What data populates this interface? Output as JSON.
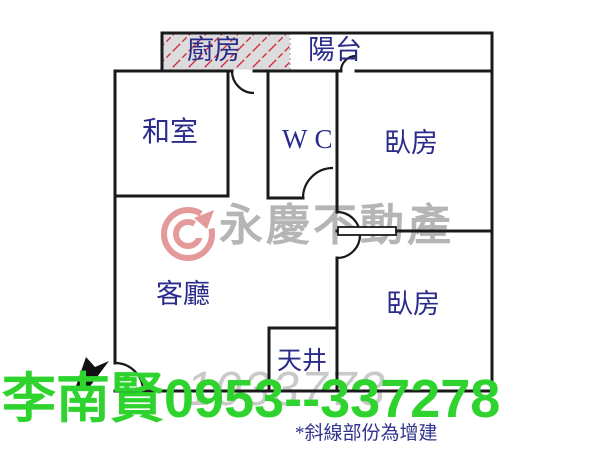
{
  "floorplan": {
    "rooms": [
      {
        "id": "kitchen",
        "label": "廚房"
      },
      {
        "id": "balcony",
        "label": "陽台"
      },
      {
        "id": "tatami_room",
        "label": "和室"
      },
      {
        "id": "wc",
        "label": "WC"
      },
      {
        "id": "bedroom_top",
        "label": "臥房"
      },
      {
        "id": "living_room",
        "label": "客廳"
      },
      {
        "id": "light_well",
        "label": "天井"
      },
      {
        "id": "bedroom_bottom",
        "label": "臥房"
      }
    ],
    "legend_note": "*斜線部份為增建",
    "colors": {
      "wall": "#1a1a1a",
      "room_label": "#2b2b8a",
      "hatch_line": "#cc3344",
      "hatch_background": "#dcdcdc"
    }
  },
  "watermark": {
    "brand": "永慶不動產",
    "logo": "yungching-circle-logo",
    "number": "1033773",
    "brand_color": "#b5b5b5",
    "number_color": "#c9c9c9",
    "logo_color": "#e49a9a"
  },
  "overlay": {
    "agent_contact": "李南賢0953--337278",
    "contact_color": "#2ed32e"
  }
}
